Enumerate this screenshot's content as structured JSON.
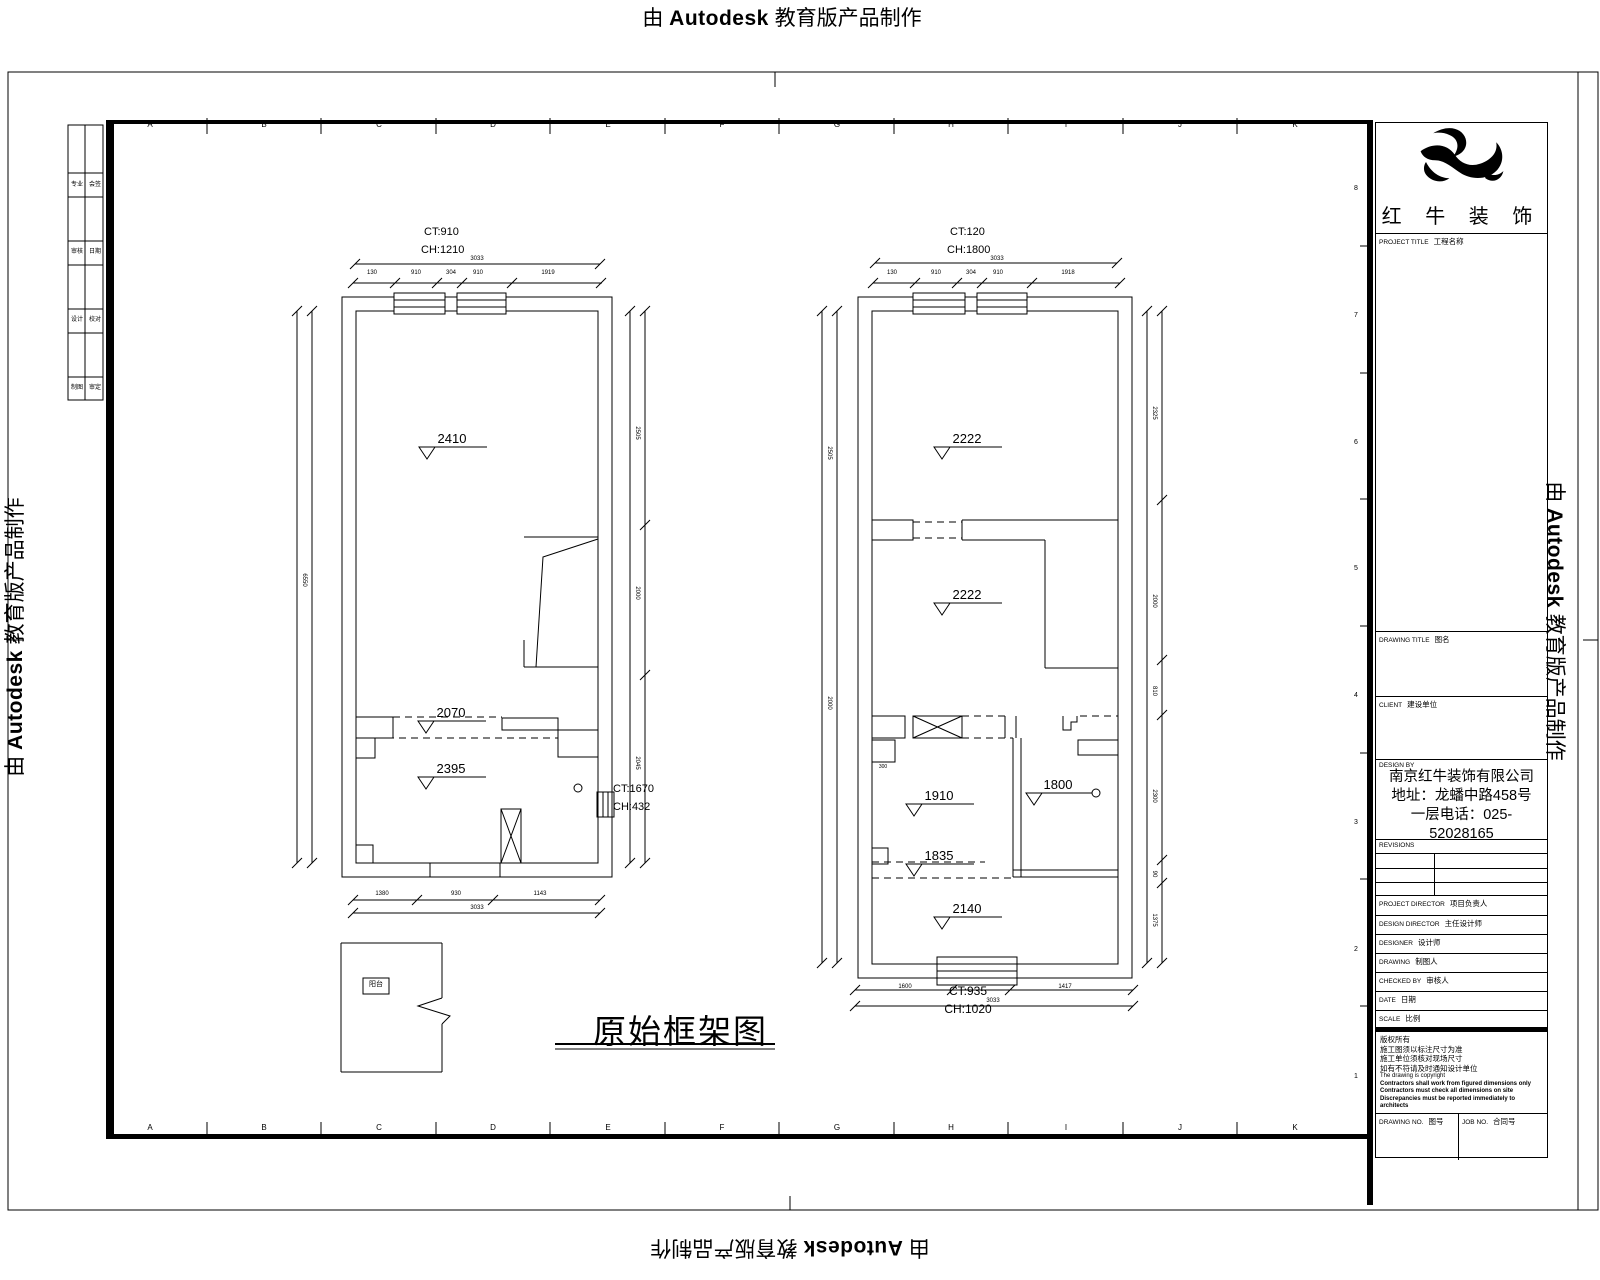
{
  "watermark": {
    "prefix": "由",
    "brand": "Autodesk",
    "suffix": "教育版产品制作"
  },
  "drawing_title_text": "原始框架图",
  "plans": {
    "left": {
      "ct_top": "CT:910",
      "ch_top": "CH:1210",
      "ct_side": "CT:1670",
      "ch_side": "CH:432",
      "elevations": [
        "2410",
        "2070",
        "2395"
      ]
    },
    "right": {
      "ct_top": "CT:120",
      "ch_top": "CH:1800",
      "ct_bottom": "CT:935",
      "ch_bottom": "CH:1020",
      "elevations": [
        "2222",
        "2222",
        "1910",
        "1800",
        "1835",
        "2140"
      ]
    }
  },
  "titleblock": {
    "company_name": "红 牛 装 饰",
    "project": {
      "en": "PROJECT TITLE",
      "cn": "工程名称"
    },
    "drawing_title": {
      "en": "DRAWING TITLE",
      "cn": "图名"
    },
    "client": {
      "en": "CLIENT",
      "cn": "建设单位"
    },
    "design": {
      "en": "DESIGN BY"
    },
    "company_info": [
      "南京红牛装饰有限公司",
      "地址：龙蟠中路458号一层",
      "电话：025-52028165"
    ],
    "revisions": "REVISIONS",
    "rows": [
      {
        "en": "PROJECT DIRECTOR",
        "cn": "项目负责人"
      },
      {
        "en": "DESIGN DIRECTOR",
        "cn": "主任设计师"
      },
      {
        "en": "DESIGNER",
        "cn": "设计师"
      },
      {
        "en": "DRAWING",
        "cn": "制图人"
      },
      {
        "en": "CHECKED BY",
        "cn": "审核人"
      },
      {
        "en": "DATE",
        "cn": "日期"
      },
      {
        "en": "SCALE",
        "cn": "比例"
      }
    ],
    "notes_cn": [
      "版权所有",
      "施工图须以标注尺寸为准",
      "施工单位须核对现场尺寸",
      "如有不符请及时通知设计单位"
    ],
    "notes_en": [
      "The drawing is copyright",
      "Contractors shall work from figured dimensions only",
      "Contractors must check all dimensions on site",
      "Discrepancies must be reported immediately to architects"
    ],
    "nos": {
      "drawing_en": "DRAWING NO.",
      "drawing_cn": "图号",
      "job_en": "JOB NO.",
      "job_cn": "合同号"
    }
  },
  "labels": [
    {
      "n": "col-a-top",
      "t": "A",
      "x": 150,
      "y": 121,
      "s": 8,
      "c": 1
    },
    {
      "n": "col-b-top",
      "t": "B",
      "x": 264,
      "y": 121,
      "s": 8,
      "c": 1
    },
    {
      "n": "col-c-top",
      "t": "C",
      "x": 379,
      "y": 121,
      "s": 8,
      "c": 1
    },
    {
      "n": "col-d-top",
      "t": "D",
      "x": 493,
      "y": 121,
      "s": 8,
      "c": 1
    },
    {
      "n": "col-e-top",
      "t": "E",
      "x": 608,
      "y": 121,
      "s": 8,
      "c": 1
    },
    {
      "n": "col-f-top",
      "t": "F",
      "x": 722,
      "y": 121,
      "s": 8,
      "c": 1
    },
    {
      "n": "col-g-top",
      "t": "G",
      "x": 837,
      "y": 121,
      "s": 8,
      "c": 1
    },
    {
      "n": "col-h-top",
      "t": "H",
      "x": 951,
      "y": 121,
      "s": 8,
      "c": 1
    },
    {
      "n": "col-i-top",
      "t": "I",
      "x": 1066,
      "y": 121,
      "s": 8,
      "c": 1
    },
    {
      "n": "col-j-top",
      "t": "J",
      "x": 1180,
      "y": 121,
      "s": 8,
      "c": 1
    },
    {
      "n": "col-k-top",
      "t": "K",
      "x": 1295,
      "y": 121,
      "s": 8,
      "c": 1
    },
    {
      "n": "col-a-bot",
      "t": "A",
      "x": 150,
      "y": 1124,
      "s": 8,
      "c": 1
    },
    {
      "n": "col-b-bot",
      "t": "B",
      "x": 264,
      "y": 1124,
      "s": 8,
      "c": 1
    },
    {
      "n": "col-c-bot",
      "t": "C",
      "x": 379,
      "y": 1124,
      "s": 8,
      "c": 1
    },
    {
      "n": "col-d-bot",
      "t": "D",
      "x": 493,
      "y": 1124,
      "s": 8,
      "c": 1
    },
    {
      "n": "col-e-bot",
      "t": "E",
      "x": 608,
      "y": 1124,
      "s": 8,
      "c": 1
    },
    {
      "n": "col-f-bot",
      "t": "F",
      "x": 722,
      "y": 1124,
      "s": 8,
      "c": 1
    },
    {
      "n": "col-g-bot",
      "t": "G",
      "x": 837,
      "y": 1124,
      "s": 8,
      "c": 1
    },
    {
      "n": "col-h-bot",
      "t": "H",
      "x": 951,
      "y": 1124,
      "s": 8,
      "c": 1
    },
    {
      "n": "col-i-bot",
      "t": "I",
      "x": 1066,
      "y": 1124,
      "s": 8,
      "c": 1
    },
    {
      "n": "col-j-bot",
      "t": "J",
      "x": 1180,
      "y": 1124,
      "s": 8,
      "c": 1
    },
    {
      "n": "col-k-bot",
      "t": "K",
      "x": 1295,
      "y": 1124,
      "s": 8,
      "c": 1
    },
    {
      "n": "row-8",
      "t": "8",
      "x": 1354,
      "y": 185,
      "s": 7
    },
    {
      "n": "row-7",
      "t": "7",
      "x": 1354,
      "y": 312,
      "s": 7
    },
    {
      "n": "row-6",
      "t": "6",
      "x": 1354,
      "y": 439,
      "s": 7
    },
    {
      "n": "row-5",
      "t": "5",
      "x": 1354,
      "y": 565,
      "s": 7
    },
    {
      "n": "row-4",
      "t": "4",
      "x": 1354,
      "y": 692,
      "s": 7
    },
    {
      "n": "row-3",
      "t": "3",
      "x": 1354,
      "y": 819,
      "s": 7
    },
    {
      "n": "row-2",
      "t": "2",
      "x": 1354,
      "y": 946,
      "s": 7
    },
    {
      "n": "row-1",
      "t": "1",
      "x": 1354,
      "y": 1073,
      "s": 7
    },
    {
      "n": "ct-left-top",
      "t": "CT:910",
      "x": 424,
      "y": 227,
      "s": 11
    },
    {
      "n": "ch-left-top",
      "t": "CH:1210",
      "x": 421,
      "y": 245,
      "s": 11
    },
    {
      "n": "ct-right-top",
      "t": "CT:120",
      "x": 950,
      "y": 227,
      "s": 11
    },
    {
      "n": "ch-right-top",
      "t": "CH:1800",
      "x": 947,
      "y": 245,
      "s": 11
    },
    {
      "n": "ct-left-side",
      "t": "CT:1670",
      "x": 613,
      "y": 784,
      "s": 11
    },
    {
      "n": "ch-left-side",
      "t": "CH:432",
      "x": 613,
      "y": 802,
      "s": 11
    },
    {
      "n": "ct-right-bottom",
      "t": "CT:935",
      "x": 968,
      "y": 985,
      "s": 12,
      "c": 1
    },
    {
      "n": "ch-right-bottom",
      "t": "CH:1020",
      "x": 968,
      "y": 1003,
      "s": 12,
      "c": 1
    },
    {
      "n": "elev-2410",
      "t": "2410",
      "x": 452,
      "y": 432,
      "s": 13,
      "c": 1
    },
    {
      "n": "elev-2070",
      "t": "2070",
      "x": 451,
      "y": 706,
      "s": 13,
      "c": 1
    },
    {
      "n": "elev-2395",
      "t": "2395",
      "x": 451,
      "y": 762,
      "s": 13,
      "c": 1
    },
    {
      "n": "elev-2222-a",
      "t": "2222",
      "x": 967,
      "y": 432,
      "s": 13,
      "c": 1
    },
    {
      "n": "elev-2222-b",
      "t": "2222",
      "x": 967,
      "y": 588,
      "s": 13,
      "c": 1
    },
    {
      "n": "elev-1910",
      "t": "1910",
      "x": 939,
      "y": 789,
      "s": 13,
      "c": 1
    },
    {
      "n": "elev-1800",
      "t": "1800",
      "x": 1058,
      "y": 778,
      "s": 13,
      "c": 1
    },
    {
      "n": "elev-1835",
      "t": "1835",
      "x": 939,
      "y": 849,
      "s": 13,
      "c": 1
    },
    {
      "n": "elev-2140",
      "t": "2140",
      "x": 967,
      "y": 902,
      "s": 13,
      "c": 1
    },
    {
      "n": "dim-total",
      "t": "3033",
      "x": 477,
      "y": 256,
      "s": 6,
      "c": 1
    },
    {
      "n": "dim",
      "t": "130",
      "x": 372,
      "y": 270,
      "s": 6,
      "c": 1
    },
    {
      "n": "dim",
      "t": "910",
      "x": 416,
      "y": 270,
      "s": 6,
      "c": 1
    },
    {
      "n": "dim",
      "t": "304",
      "x": 451,
      "y": 270,
      "s": 6,
      "c": 1
    },
    {
      "n": "dim",
      "t": "910",
      "x": 478,
      "y": 270,
      "s": 6,
      "c": 1
    },
    {
      "n": "dim",
      "t": "1919",
      "x": 548,
      "y": 270,
      "s": 6,
      "c": 1
    },
    {
      "n": "dim-total",
      "t": "3033",
      "x": 997,
      "y": 256,
      "s": 6,
      "c": 1
    },
    {
      "n": "dim",
      "t": "130",
      "x": 892,
      "y": 270,
      "s": 6,
      "c": 1
    },
    {
      "n": "dim",
      "t": "910",
      "x": 936,
      "y": 270,
      "s": 6,
      "c": 1
    },
    {
      "n": "dim",
      "t": "304",
      "x": 971,
      "y": 270,
      "s": 6,
      "c": 1
    },
    {
      "n": "dim",
      "t": "910",
      "x": 998,
      "y": 270,
      "s": 6,
      "c": 1
    },
    {
      "n": "dim",
      "t": "1918",
      "x": 1068,
      "y": 270,
      "s": 6,
      "c": 1
    },
    {
      "n": "dim",
      "t": "1380",
      "x": 382,
      "y": 891,
      "s": 6,
      "c": 1
    },
    {
      "n": "dim",
      "t": "930",
      "x": 456,
      "y": 891,
      "s": 6,
      "c": 1
    },
    {
      "n": "dim",
      "t": "1143",
      "x": 540,
      "y": 891,
      "s": 6,
      "c": 1
    },
    {
      "n": "dim-total",
      "t": "3033",
      "x": 477,
      "y": 905,
      "s": 6,
      "c": 1
    },
    {
      "n": "dim",
      "t": "1600",
      "x": 905,
      "y": 984,
      "s": 6,
      "c": 1
    },
    {
      "n": "dim",
      "t": "1417",
      "x": 1065,
      "y": 984,
      "s": 6,
      "c": 1
    },
    {
      "n": "dim-total",
      "t": "3033",
      "x": 993,
      "y": 998,
      "s": 6,
      "c": 1
    },
    {
      "n": "dim-v",
      "t": "6550",
      "x": 304,
      "y": 577,
      "s": 6,
      "r": 90,
      "c": 1
    },
    {
      "n": "dim-v",
      "t": "2505",
      "x": 637,
      "y": 430,
      "s": 6,
      "r": 90,
      "c": 1
    },
    {
      "n": "dim-v",
      "t": "2000",
      "x": 637,
      "y": 590,
      "s": 6,
      "r": 90,
      "c": 1
    },
    {
      "n": "dim-v",
      "t": "2045",
      "x": 637,
      "y": 760,
      "s": 6,
      "r": 90,
      "c": 1
    },
    {
      "n": "dim-v",
      "t": "2505",
      "x": 829,
      "y": 450,
      "s": 6,
      "r": 90,
      "c": 1
    },
    {
      "n": "dim-v",
      "t": "2000",
      "x": 829,
      "y": 700,
      "s": 6,
      "r": 90,
      "c": 1
    },
    {
      "n": "dim-v",
      "t": "2325",
      "x": 1154,
      "y": 410,
      "s": 6,
      "r": 90,
      "c": 1
    },
    {
      "n": "dim-v",
      "t": "2000",
      "x": 1154,
      "y": 598,
      "s": 6,
      "r": 90,
      "c": 1
    },
    {
      "n": "dim-v",
      "t": "810",
      "x": 1154,
      "y": 688,
      "s": 6,
      "r": 90,
      "c": 1
    },
    {
      "n": "dim-v",
      "t": "2300",
      "x": 1154,
      "y": 793,
      "s": 6,
      "r": 90,
      "c": 1
    },
    {
      "n": "dim-v",
      "t": "90",
      "x": 1154,
      "y": 871,
      "s": 6,
      "r": 90,
      "c": 1
    },
    {
      "n": "dim-v",
      "t": "1375",
      "x": 1154,
      "y": 917,
      "s": 6,
      "r": 90,
      "c": 1
    },
    {
      "n": "dim",
      "t": "300",
      "x": 883,
      "y": 765,
      "s": 5,
      "c": 1
    },
    {
      "n": "strip-cell",
      "t": "专业",
      "x": 77,
      "y": 182,
      "s": 6,
      "c": 1
    },
    {
      "n": "strip-cell",
      "t": "会签",
      "x": 95,
      "y": 182,
      "s": 6,
      "c": 1
    },
    {
      "n": "strip-cell",
      "t": "审核",
      "x": 77,
      "y": 249,
      "s": 6,
      "c": 1
    },
    {
      "n": "strip-cell",
      "t": "日期",
      "x": 95,
      "y": 249,
      "s": 6,
      "c": 1
    },
    {
      "n": "strip-cell",
      "t": "设计",
      "x": 77,
      "y": 317,
      "s": 6,
      "c": 1
    },
    {
      "n": "strip-cell",
      "t": "校对",
      "x": 95,
      "y": 317,
      "s": 6,
      "c": 1
    },
    {
      "n": "strip-cell",
      "t": "制图",
      "x": 77,
      "y": 385,
      "s": 6,
      "c": 1
    },
    {
      "n": "strip-cell",
      "t": "审定",
      "x": 95,
      "y": 385,
      "s": 6,
      "c": 1
    },
    {
      "n": "balcony-label",
      "t": "阳台",
      "x": 376,
      "y": 981,
      "s": 7,
      "c": 1
    }
  ]
}
